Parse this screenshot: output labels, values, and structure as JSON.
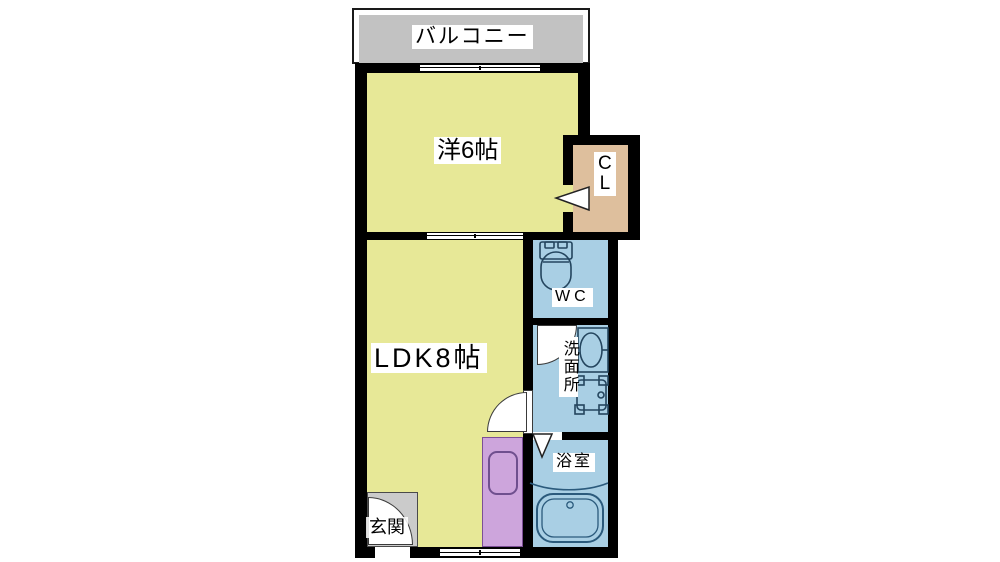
{
  "plan": {
    "title": "1LDK floor plan",
    "labels": {
      "balcony": "バルコニー",
      "western_room": "洋6帖",
      "closet_c": "C",
      "closet_l": "L",
      "ldk": "LDK8帖",
      "wc": "WC",
      "washroom": "洗面所",
      "bathroom": "浴室",
      "entrance": "玄関"
    },
    "colors": {
      "wall": "#000000",
      "room_yellow": "#e7e897",
      "water_blue": "#a9cfe4",
      "closet_tan": "#debf9d",
      "kitchen_purple": "#cda5dc",
      "balcony_gray": "#c2c2c2",
      "entrance_gray": "#cbcbcb",
      "fixture_outline": "#24455e",
      "kitchen_outline": "#6f4f8e"
    }
  }
}
